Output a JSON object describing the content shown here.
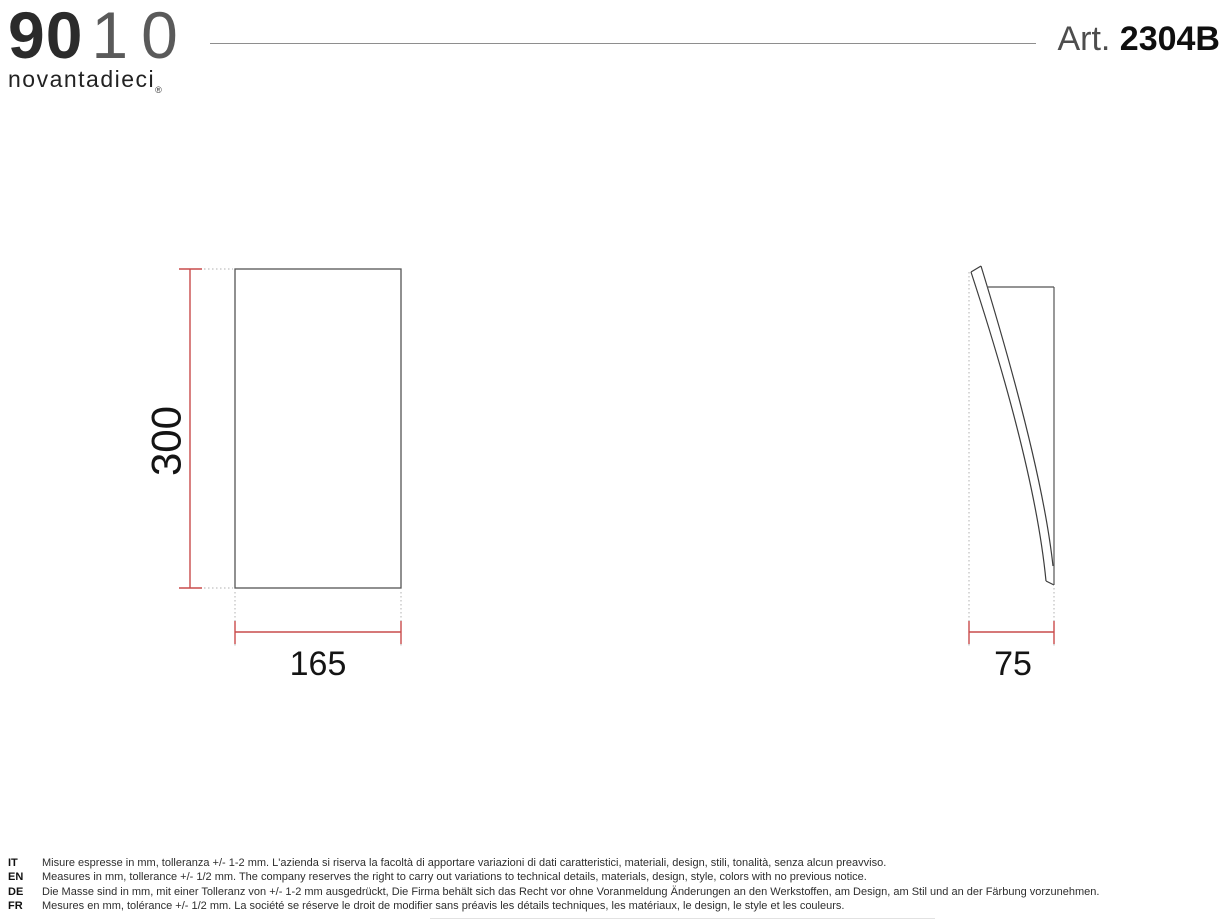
{
  "header": {
    "logo": {
      "digits_bold": "90",
      "digits_light": "10",
      "wordmark": "novantadieci",
      "registered_mark": "®"
    },
    "art_label": "Art.",
    "art_number": "2304B"
  },
  "drawing": {
    "front_view": {
      "height_mm": "300",
      "width_mm": "165"
    },
    "side_view": {
      "depth_mm": "75"
    },
    "dimension_color": "#c94b4b",
    "outline_color": "#555555"
  },
  "footer": {
    "notes": [
      {
        "lang": "IT",
        "text": "Misure espresse in mm, tolleranza +/- 1-2 mm. L'azienda si riserva la facoltà di apportare variazioni di dati caratteristici, materiali, design, stili, tonalità, senza alcun preavviso."
      },
      {
        "lang": "EN",
        "text": "Measures in mm, tollerance +/- 1/2 mm. The company reserves the right to carry out variations to technical details, materials, design, style, colors with no previous notice."
      },
      {
        "lang": "DE",
        "text": "Die Masse sind in mm, mit einer Tolleranz von +/- 1-2 mm ausgedrückt, Die Firma behält sich das Recht vor ohne Voranmeldung Änderungen an den Werkstoffen, am Design, am Stil und an der Färbung vorzunehmen."
      },
      {
        "lang": "FR",
        "text": "Mesures en mm, tolérance +/- 1/2 mm. La société se réserve le droit de modifier sans préavis les détails techniques, les matériaux, le design, le style et les couleurs."
      }
    ]
  }
}
